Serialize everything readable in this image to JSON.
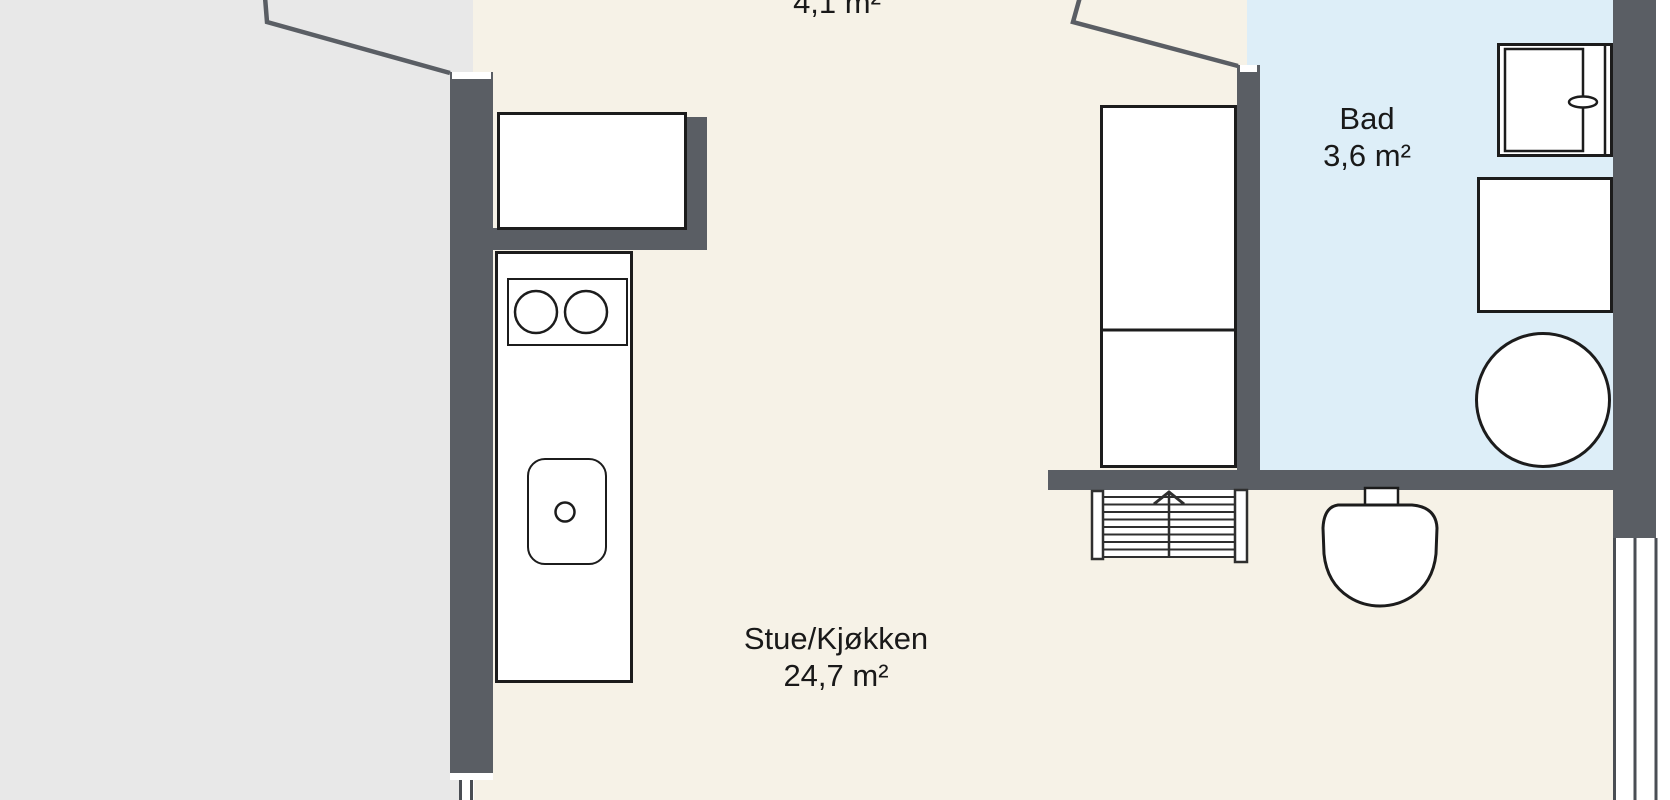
{
  "plan_title": "Apartment floor plan",
  "rooms": [
    {
      "id": "hall",
      "name": "",
      "area_label": "4,1 m²"
    },
    {
      "id": "stue_kjokken",
      "name": "Stue/Kjøkken",
      "area_label": "24,7 m²"
    },
    {
      "id": "bad",
      "name": "Bad",
      "area_label": "3,6 m²"
    }
  ],
  "fixtures": [
    "hall-cabinet",
    "kitchen-counter",
    "cooktop",
    "kitchen-sink",
    "tall-cabinet",
    "staircase",
    "toilet",
    "shower-cabin",
    "bathroom-cabinet",
    "round-tub"
  ],
  "colors": {
    "wall": "#5a5e64",
    "floor_main": "#f6f2e7",
    "floor_bath": "#ddeef8",
    "exterior": "#e8e8e8",
    "outside": "#ffffff",
    "white": "#ffffff",
    "fixture_border": "#1c1c1c",
    "stair_line": "#2f2f2f",
    "window_line": "#4a4e54",
    "text": "#191919"
  }
}
